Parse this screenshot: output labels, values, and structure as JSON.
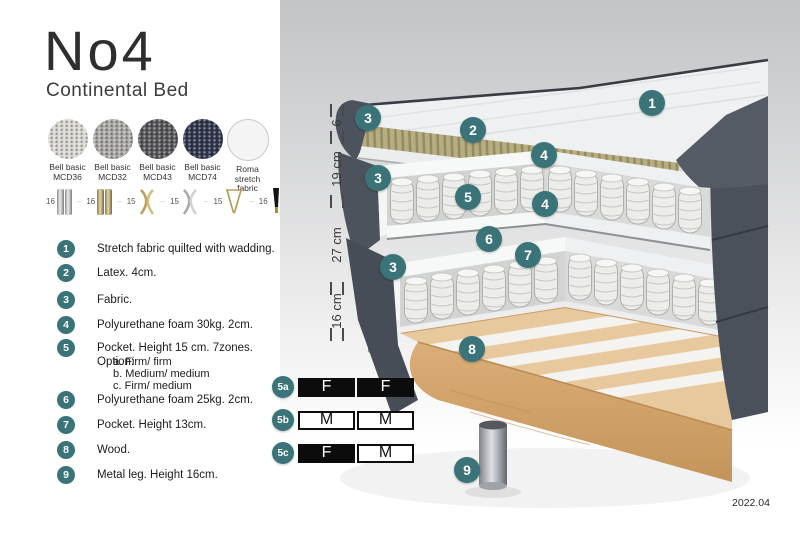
{
  "header": {
    "title": "No4",
    "subtitle": "Continental Bed"
  },
  "fabrics": {
    "items": [
      {
        "line1": "Bell basic",
        "line2": "MCD36",
        "color": "#d9d7d2"
      },
      {
        "line1": "Bell basic",
        "line2": "MCD32",
        "color": "#a9a8a4"
      },
      {
        "line1": "Bell basic",
        "line2": "MCD43",
        "color": "#58585a"
      },
      {
        "line1": "Bell basic",
        "line2": "MCD74",
        "color": "#31374f"
      },
      {
        "line1": "Roma",
        "line2": "stretch fabric",
        "color": "#f4f4f4"
      }
    ]
  },
  "legs": {
    "items": [
      {
        "height": "16",
        "type": "cylinder-silver"
      },
      {
        "height": "16",
        "type": "cylinder-gold"
      },
      {
        "height": "15",
        "type": "twisted-gold"
      },
      {
        "height": "15",
        "type": "twisted-silver"
      },
      {
        "height": "15",
        "type": "hairpin-gold"
      },
      {
        "height": "16",
        "type": "tapered-black-gold"
      }
    ]
  },
  "features": [
    {
      "num": "1",
      "text": "Stretch fabric quilted with wadding."
    },
    {
      "num": "2",
      "text": "Latex. 4cm."
    },
    {
      "num": "3",
      "text": "Fabric."
    },
    {
      "num": "4",
      "text": "Polyurethane foam 30kg. 2cm."
    },
    {
      "num": "5",
      "text": "Pocket. Height 15 cm. 7zones. Option:",
      "options": [
        "a. Firm/ firm",
        "b. Medium/ medium",
        "c. Firm/ medium"
      ]
    },
    {
      "num": "6",
      "text": "Polyurethane foam 25kg. 2cm."
    },
    {
      "num": "7",
      "text": "Pocket. Height 13cm."
    },
    {
      "num": "8",
      "text": "Wood."
    },
    {
      "num": "9",
      "text": "Metal leg. Height 16cm."
    }
  ],
  "diagram": {
    "dimensions": [
      "6",
      "19 cm",
      "27 cm",
      "16 cm"
    ],
    "callouts": {
      "n1": "1",
      "n2": "2",
      "n3": "3",
      "n4": "4",
      "n5": "5",
      "n6": "6",
      "n7": "7",
      "n8": "8",
      "n9": "9"
    },
    "firmness": [
      {
        "label": "5a",
        "left": "F",
        "right": "F"
      },
      {
        "label": "5b",
        "left": "M",
        "right": "M"
      },
      {
        "label": "5c",
        "left": "F",
        "right": "M"
      }
    ],
    "version": "2022.04"
  },
  "colors": {
    "accent": "#3a7478",
    "dark_fabric": "#4d535d",
    "latex": "#b3aa7f",
    "wood": "#e2bf8e",
    "black": "#0c0c0c"
  }
}
